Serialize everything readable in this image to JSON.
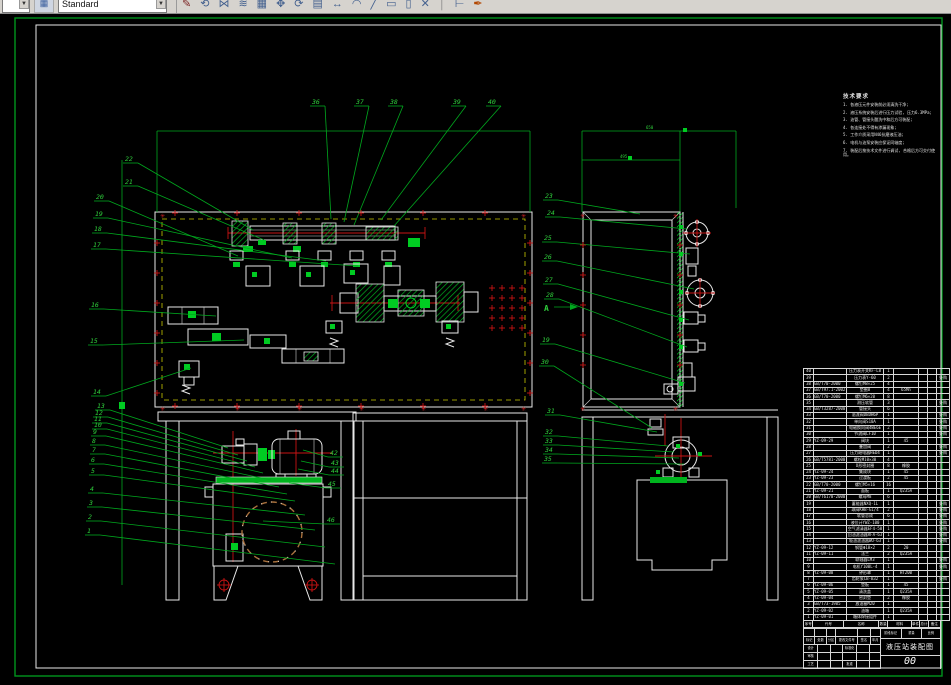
{
  "toolbar": {
    "style_value": "Standard",
    "icons": [
      {
        "name": "sketch-icon",
        "glyph": "✎",
        "color": "#7a1f1f"
      },
      {
        "name": "rotate-copy-icon",
        "glyph": "⟲",
        "color": "#44618f"
      },
      {
        "name": "mirror-icon",
        "glyph": "⋈",
        "color": "#44618f"
      },
      {
        "name": "offset-icon",
        "glyph": "≋",
        "color": "#44618f"
      },
      {
        "name": "array-icon",
        "glyph": "▦",
        "color": "#44618f"
      },
      {
        "name": "move-icon",
        "glyph": "✥",
        "color": "#44618f"
      },
      {
        "name": "rotate-icon",
        "glyph": "⟳",
        "color": "#44618f"
      },
      {
        "name": "grid-icon",
        "glyph": "▤",
        "color": "#44618f"
      },
      {
        "name": "stretch-icon",
        "glyph": "↔",
        "color": "#44618f"
      },
      {
        "name": "fillet-icon",
        "glyph": "◠",
        "color": "#44618f"
      },
      {
        "name": "chamfer-icon",
        "glyph": "╱",
        "color": "#44618f"
      },
      {
        "name": "rect-icon",
        "glyph": "▭",
        "color": "#44618f"
      },
      {
        "name": "rect2-icon",
        "glyph": "▯",
        "color": "#44618f"
      },
      {
        "name": "explode-icon",
        "glyph": "✕",
        "color": "#44618f"
      },
      {
        "name": "divider-icon",
        "glyph": "│",
        "color": "#888888"
      },
      {
        "name": "measure-icon",
        "glyph": "⊢",
        "color": "#44618f"
      },
      {
        "name": "brush-icon",
        "glyph": "✒",
        "color": "#b34700"
      }
    ]
  },
  "notes": {
    "title": "技术要求",
    "lines": [
      "1. 各液压元件安装前必须清洗干净;",
      "2. 液压系统安装后进行压力试验, 压力6.3MPa;",
      "3. 油管、管接头酸洗中和后方可装配;",
      "4. 各连接处不得有渗漏现象;",
      "5. 工作介质采用N46抗磨液压油;",
      "6. 电机与油泵安装应保证同轴度;",
      "7. 装配后按技术文件进行调试, 合格后方可交付使用。"
    ]
  },
  "section_marker": {
    "label": "A"
  },
  "dimensions": [
    {
      "t": "650",
      "x": 646,
      "y": 129
    },
    {
      "t": "495",
      "x": 620,
      "y": 158
    }
  ],
  "callouts": {
    "left": [
      [
        22,
        125,
        155,
        253,
        230
      ],
      [
        21,
        125,
        178,
        264,
        240
      ],
      [
        20,
        96,
        193,
        238,
        256
      ],
      [
        19,
        95,
        210,
        292,
        258
      ],
      [
        18,
        94,
        225,
        326,
        261
      ],
      [
        17,
        93,
        241,
        358,
        266
      ],
      [
        16,
        91,
        301,
        216,
        316
      ],
      [
        15,
        90,
        337,
        244,
        340
      ],
      [
        14,
        93,
        388,
        191,
        368
      ],
      [
        13,
        97,
        402,
        228,
        448
      ],
      [
        12,
        95,
        409,
        238,
        455
      ],
      [
        11,
        94,
        415,
        247,
        461
      ],
      [
        10,
        94,
        421,
        255,
        467
      ],
      [
        9,
        93,
        428,
        263,
        473
      ],
      [
        8,
        92,
        437,
        271,
        480
      ],
      [
        7,
        92,
        446,
        279,
        487
      ],
      [
        6,
        91,
        456,
        287,
        494
      ],
      [
        5,
        91,
        467,
        295,
        501
      ],
      [
        4,
        90,
        485,
        305,
        515
      ],
      [
        3,
        89,
        499,
        315,
        530
      ],
      [
        2,
        88,
        513,
        325,
        547
      ],
      [
        1,
        87,
        527,
        335,
        564
      ]
    ],
    "top": [
      [
        36,
        312,
        98,
        331,
        219
      ],
      [
        37,
        356,
        98,
        344,
        222
      ],
      [
        38,
        390,
        98,
        354,
        225
      ],
      [
        39,
        453,
        98,
        381,
        220
      ],
      [
        40,
        488,
        98,
        394,
        226
      ]
    ],
    "middle": [
      [
        23,
        545,
        192,
        640,
        214
      ],
      [
        24,
        547,
        209,
        687,
        229
      ],
      [
        25,
        544,
        234,
        690,
        254
      ],
      [
        26,
        544,
        253,
        694,
        289
      ],
      [
        27,
        545,
        276,
        689,
        320
      ],
      [
        28,
        546,
        291,
        687,
        347
      ],
      [
        19,
        542,
        336,
        685,
        383
      ],
      [
        30,
        541,
        358,
        652,
        428
      ],
      [
        31,
        547,
        407,
        657,
        432
      ],
      [
        32,
        545,
        428,
        668,
        446
      ],
      [
        33,
        545,
        437,
        674,
        452
      ],
      [
        34,
        545,
        446,
        679,
        458
      ],
      [
        35,
        544,
        455,
        684,
        464
      ]
    ],
    "right": [
      [
        42,
        330,
        449,
        303,
        450
      ],
      [
        43,
        331,
        459,
        301,
        461
      ],
      [
        44,
        331,
        467,
        298,
        469
      ],
      [
        45,
        328,
        480,
        289,
        483
      ],
      [
        46,
        327,
        516,
        263,
        521
      ]
    ]
  },
  "bom": {
    "header": [
      "序号",
      "代号",
      "名称",
      "数量",
      "材料",
      "单件",
      "总计",
      "备注"
    ],
    "rows": [
      [
        40,
        "",
        "压力表开关KF-L8",
        1,
        "",
        ""
      ],
      [
        39,
        "",
        "压力表Y-60",
        2,
        "",
        "外购"
      ],
      [
        38,
        "GB/T70-2000",
        "螺钉M8×25",
        4,
        "",
        ""
      ],
      [
        37,
        "GB/T97.1-2002",
        "垫圈8",
        4,
        "65Mn",
        ""
      ],
      [
        36,
        "GB/T70-2000",
        "螺钉M6×20",
        8,
        "",
        ""
      ],
      [
        35,
        "",
        "测压软管",
        3,
        "",
        "外购"
      ],
      [
        34,
        "GB/T3287-2000",
        "管接头",
        6,
        "",
        ""
      ],
      [
        33,
        "",
        "溢流阀DBDH6P",
        1,
        "",
        "外购"
      ],
      [
        32,
        "",
        "单向阀S10A",
        1,
        "",
        "外购"
      ],
      [
        31,
        "",
        "电磁换向阀4WE6E",
        2,
        "",
        "外购"
      ],
      [
        30,
        "",
        "节流阀LF10",
        1,
        "",
        "外购"
      ],
      [
        29,
        "YZ-09-29",
        "阀块",
        1,
        "45",
        ""
      ],
      [
        28,
        "",
        "叠加阀",
        2,
        "",
        "外购"
      ],
      [
        27,
        "",
        "压力继电器HED4",
        1,
        "",
        "外购"
      ],
      [
        26,
        "GB/T5781-2000",
        "螺栓M10×30",
        4,
        "",
        ""
      ],
      [
        25,
        "",
        "O形密封圈",
        8,
        "橡胶",
        ""
      ],
      [
        24,
        "YZ-09-24",
        "集成块",
        1,
        "45",
        ""
      ],
      [
        23,
        "YZ-09-23",
        "过渡板",
        2,
        "45",
        ""
      ],
      [
        22,
        "GB/T70-2000",
        "螺钉M5×16",
        16,
        "",
        ""
      ],
      [
        21,
        "YZ-09-21",
        "面板",
        1,
        "Q235A",
        ""
      ],
      [
        20,
        "GB/T6170-2000",
        "螺母M8",
        6,
        "",
        ""
      ],
      [
        19,
        "",
        "蓄能器NXQ-1L",
        1,
        "",
        "外购"
      ],
      [
        18,
        "",
        "球阀KHB-G1/4",
        2,
        "",
        "外购"
      ],
      [
        17,
        "",
        "软管总成",
        6,
        "",
        "外购"
      ],
      [
        16,
        "",
        "液位计YWZ-100",
        1,
        "",
        "外购"
      ],
      [
        15,
        "",
        "空气滤清器EF4-50",
        1,
        "",
        "外购"
      ],
      [
        14,
        "",
        "回油滤油器RFA-63",
        1,
        "",
        "外购"
      ],
      [
        13,
        "",
        "吸油滤油器WU-63",
        1,
        "",
        "外购"
      ],
      [
        12,
        "YZ-09-12",
        "钢管Φ18×2",
        2,
        "20",
        ""
      ],
      [
        11,
        "YZ-09-11",
        "法兰",
        2,
        "Q235A",
        ""
      ],
      [
        10,
        "",
        "联轴器LM3",
        1,
        "",
        "外购"
      ],
      [
        9,
        "",
        "电机Y100L-4",
        1,
        "",
        "外购"
      ],
      [
        8,
        "YZ-09-08",
        "钟形罩",
        1,
        "HT200",
        ""
      ],
      [
        7,
        "",
        "齿轮泵CB-B32",
        1,
        "",
        "外购"
      ],
      [
        6,
        "YZ-09-06",
        "垫板",
        1,
        "45",
        ""
      ],
      [
        5,
        "YZ-09-05",
        "清洗盖",
        1,
        "Q235A",
        ""
      ],
      [
        4,
        "YZ-09-04",
        "密封垫",
        2,
        "橡胶",
        ""
      ],
      [
        3,
        "GB/T73-1985",
        "放油塞M20",
        1,
        "",
        ""
      ],
      [
        2,
        "YZ-09-02",
        "油箱",
        1,
        "Q235A",
        ""
      ],
      [
        1,
        "YZ-09-01",
        "箱体焊接组件",
        1,
        "",
        ""
      ]
    ]
  },
  "title_block": {
    "rows": [
      [
        "",
        "",
        "",
        "",
        "",
        ""
      ],
      [
        "标记",
        "处数",
        "分区",
        "更改文件号",
        "签名",
        "年月日"
      ],
      [
        "设计",
        "",
        "",
        "标准化",
        "",
        ""
      ],
      [
        "审核",
        "",
        "",
        "",
        "",
        ""
      ],
      [
        "工艺",
        "",
        "",
        "批准",
        "",
        ""
      ]
    ],
    "stage_row": [
      "阶段标记",
      "重量",
      "比例"
    ],
    "title": "液压站装配图",
    "drawing_no": "00"
  }
}
